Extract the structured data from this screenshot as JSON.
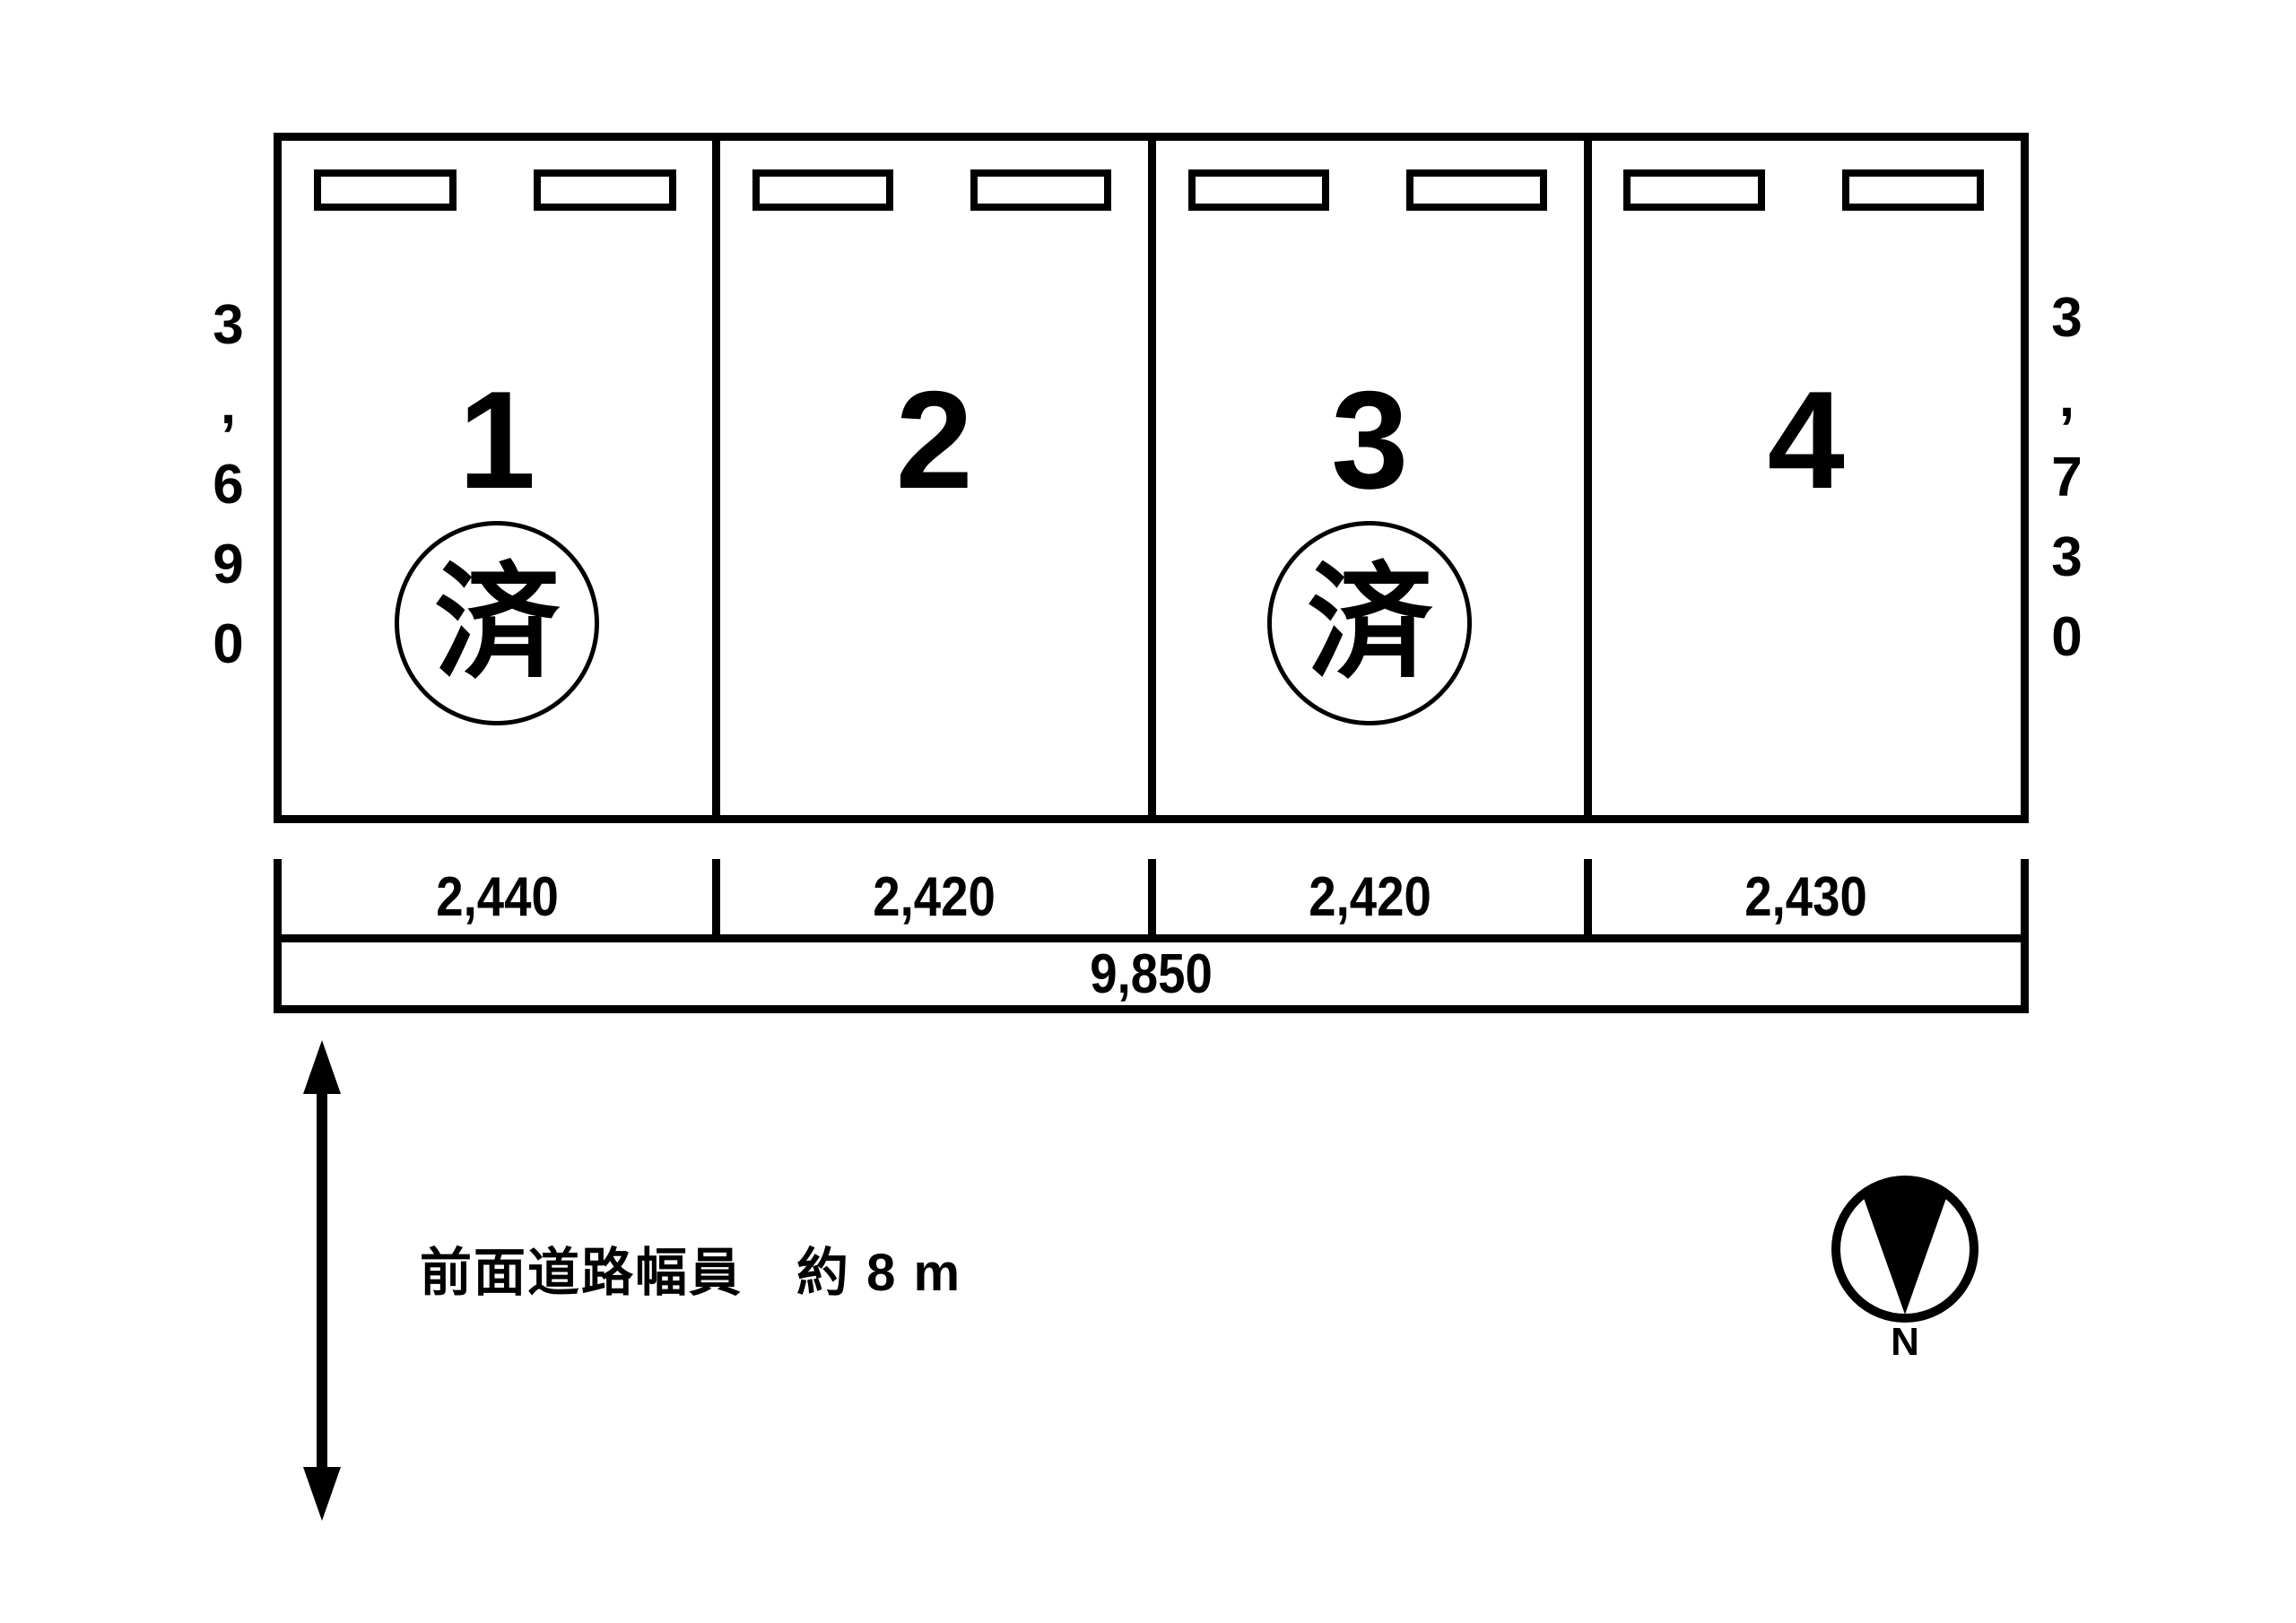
{
  "page": {
    "background_color": "#ffffff",
    "ink_color": "#000000"
  },
  "parking_layout": {
    "stalls": [
      {
        "number": "1",
        "status_stamp": "済",
        "width": "2,440"
      },
      {
        "number": "2",
        "width": "2,420"
      },
      {
        "number": "3",
        "status_stamp": "済",
        "width": "2,420"
      },
      {
        "number": "4",
        "width": "2,430"
      }
    ],
    "left_depth": "3,690",
    "right_depth": "3,730",
    "total_width": "9,850"
  },
  "road": {
    "front_road_label": "前面道路幅員　約 8 m"
  },
  "compass": {
    "north_label": "N"
  }
}
